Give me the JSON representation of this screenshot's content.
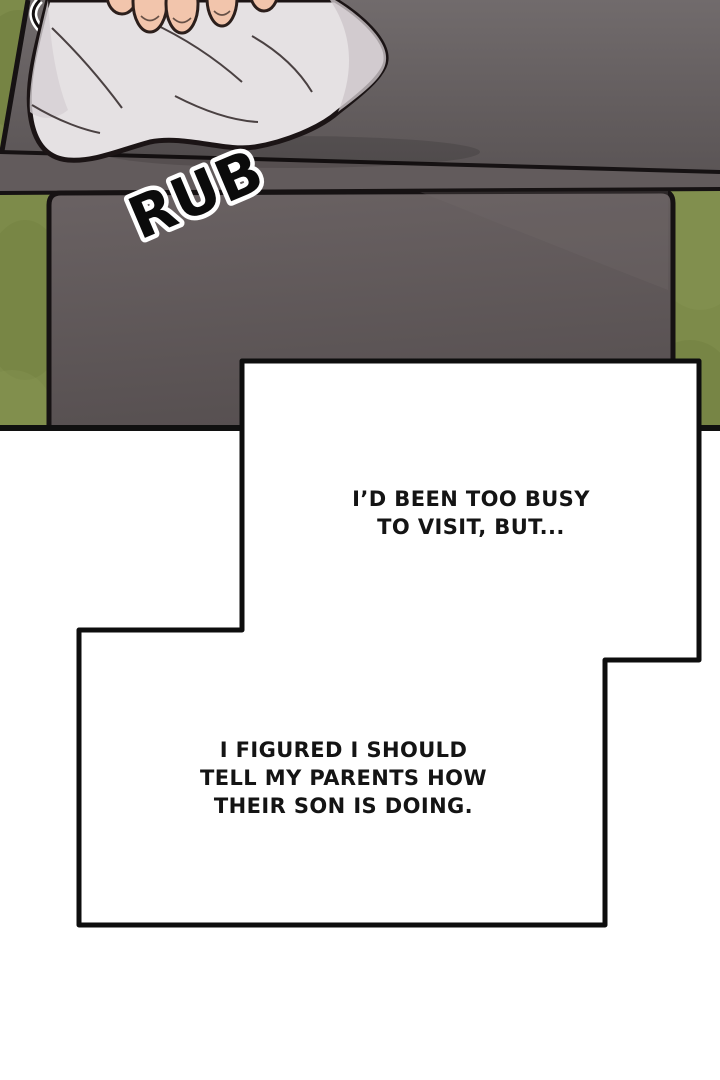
{
  "panel": {
    "sfx": "RUB",
    "colors": {
      "grass": "#7d8b4a",
      "grass_dark": "#6e7d3e",
      "stone_cap_top": "#716b6c",
      "stone_cap_bottom": "#5b5556",
      "stone_face": "#625b5c",
      "stone_body_top": "#6a6263",
      "stone_body_bottom": "#575051",
      "cloth": "#e5e1e3",
      "cloth_shadow": "#cdc6c9",
      "skin": "#f2c5ac",
      "outline": "#161213",
      "box_fill": "#ffffff",
      "box_border": "#0e0e0e"
    }
  },
  "dialogue1": {
    "lines": [
      "I’D BEEN TOO BUSY",
      "TO VISIT, BUT..."
    ]
  },
  "dialogue2": {
    "lines": [
      "I FIGURED I SHOULD",
      "TELL MY PARENTS HOW",
      "THEIR SON IS DOING."
    ]
  }
}
